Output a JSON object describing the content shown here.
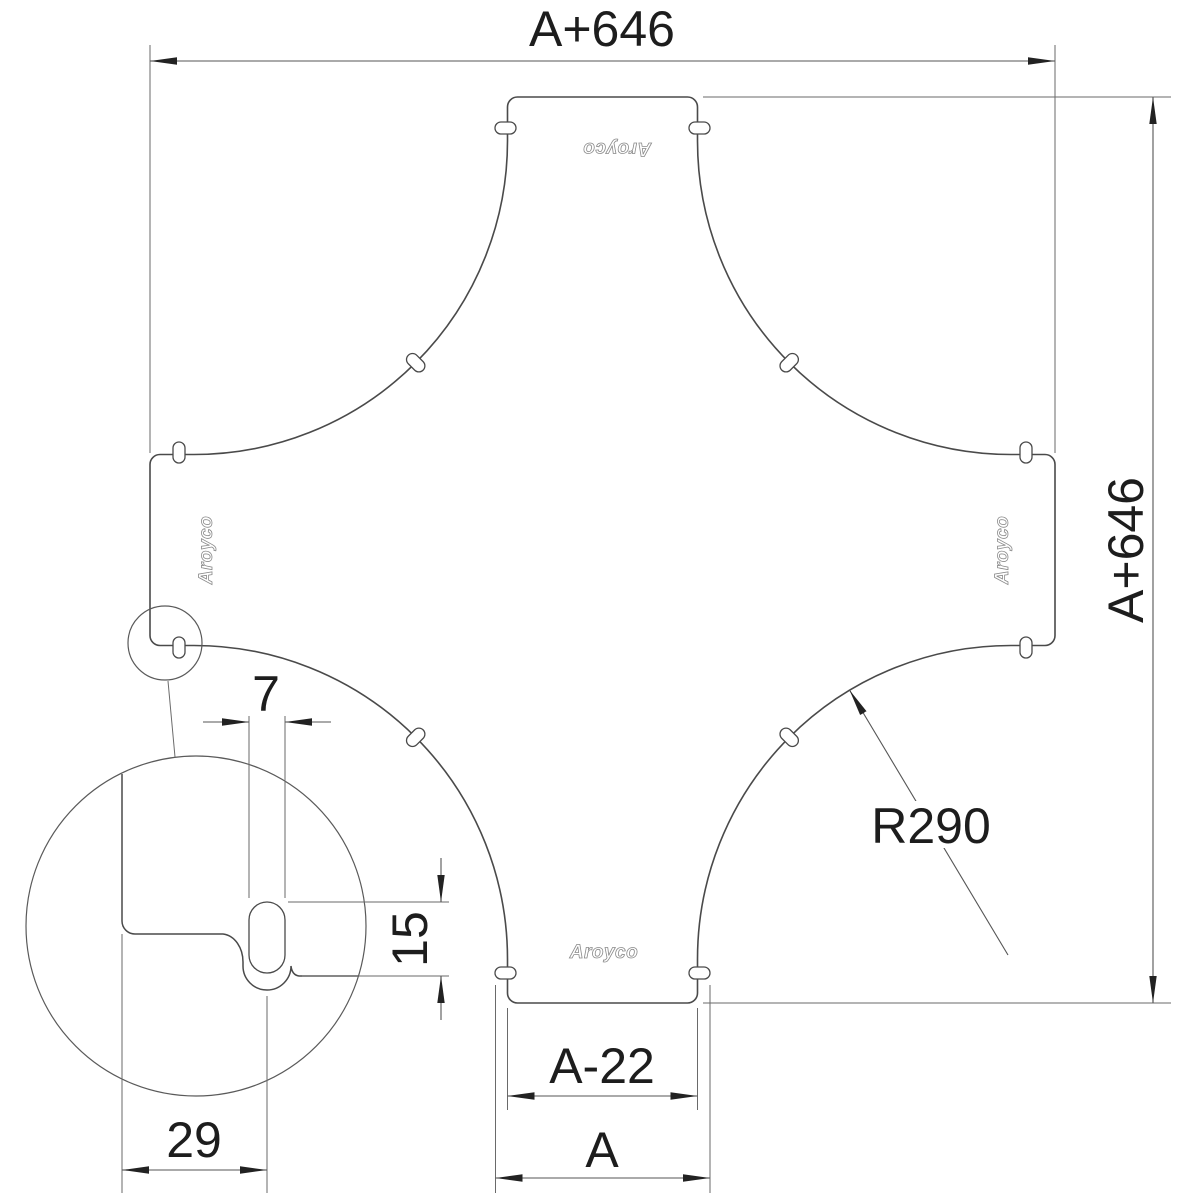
{
  "drawing": {
    "dimension_labels": {
      "overall_width": "A+646",
      "overall_height": "A+646",
      "fillet_radius": "R290",
      "arm_end_width": "A-22",
      "arm_nominal_width": "A",
      "detail_slot_width": "7",
      "detail_slot_length": "15",
      "detail_slot_edge_distance": "29"
    },
    "logo_text": "Aroyco",
    "colors": {
      "background": "#ffffff",
      "line": "#4a4a4a",
      "text": "#1d1d1d"
    }
  }
}
